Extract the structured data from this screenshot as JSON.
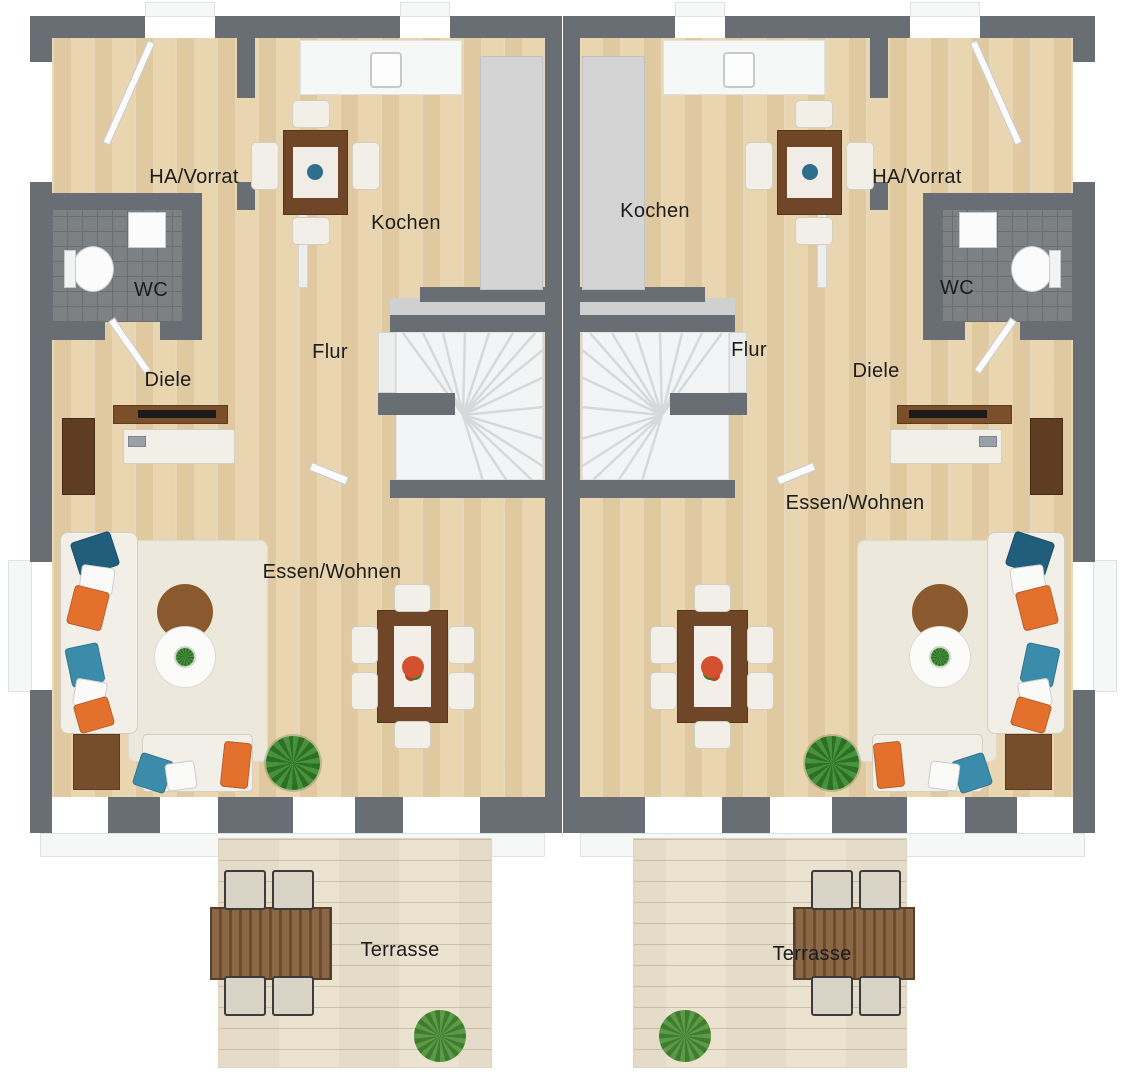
{
  "plan": {
    "type": "3d-floor-plan-duplex-ground-floor",
    "units": 2,
    "mirrored": true
  },
  "labels": {
    "left_unit": {
      "ha_vorrat": "HA/Vorrat",
      "kochen": "Kochen",
      "wc": "WC",
      "flur": "Flur",
      "diele": "Diele",
      "essen_wohnen": "Essen/Wohnen",
      "terrasse": "Terrasse"
    },
    "right_unit": {
      "ha_vorrat": "HA/Vorrat",
      "kochen": "Kochen",
      "wc": "WC",
      "flur": "Flur",
      "diele": "Diele",
      "essen_wohnen": "Essen/Wohnen",
      "terrasse": "Terrasse"
    }
  },
  "palette": {
    "wall": "#696e74",
    "wood_floor": "#e9d6b0",
    "terrace_deck": "#ebe3cf",
    "rug": "#ece8dc",
    "sofa": "#f1efe8",
    "pillow_orange": "#e4702e",
    "pillow_blue": "#3b8cab",
    "pillow_teal": "#205e7c",
    "furniture_brown": "#6f4628",
    "plant_green": "#47923b",
    "wc_tile": "#7d8184",
    "stairs": "#f3f4f5"
  }
}
